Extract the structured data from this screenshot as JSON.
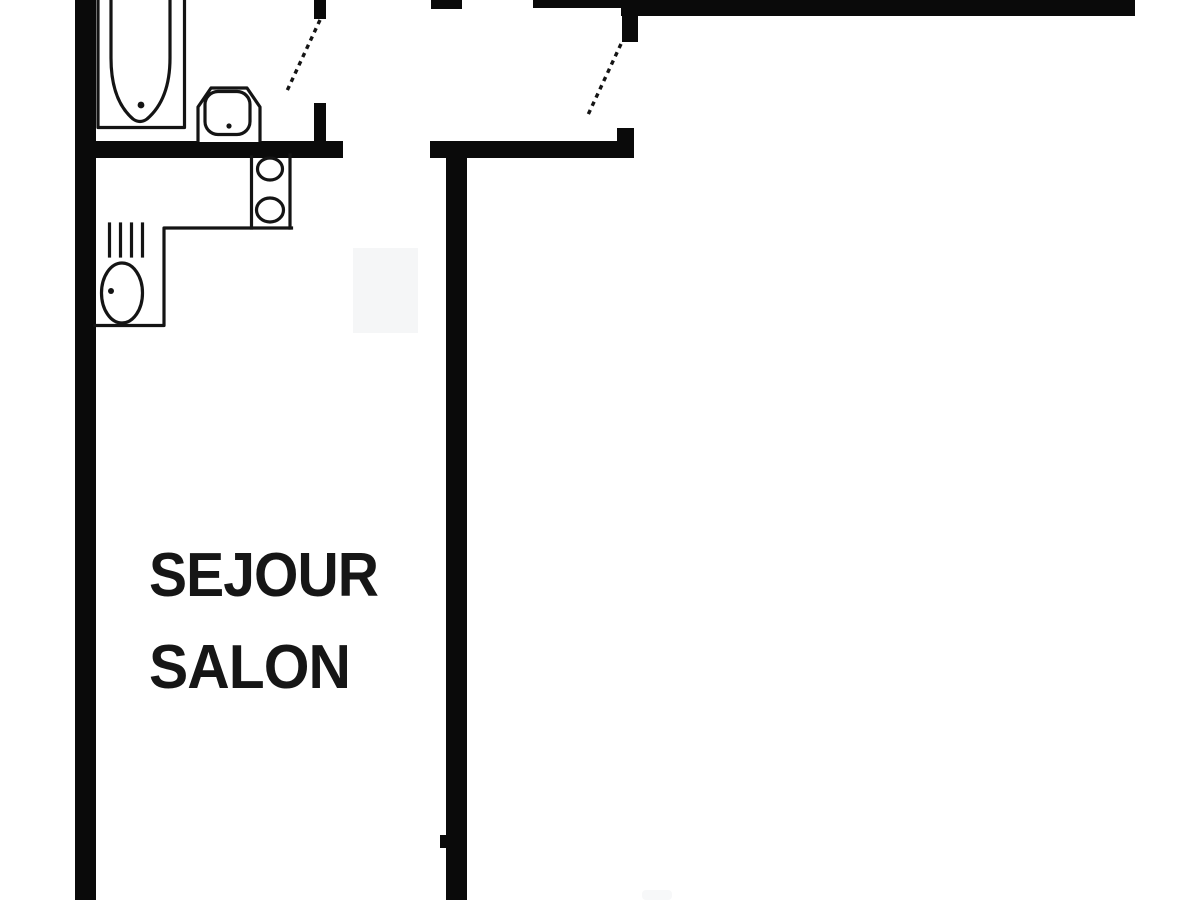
{
  "colors": {
    "background": "#ffffff",
    "walls": "#0a0a0a",
    "fixture_lines": "#141414",
    "label_text": "#161616",
    "faint_patch": "#f5f6f7"
  },
  "rooms": [
    {
      "id": "sejour-salon",
      "lines": [
        "SEJOUR",
        "SALON"
      ]
    }
  ],
  "fixtures": [
    {
      "icon": "bathtub-icon",
      "room": "bathroom"
    },
    {
      "icon": "washbasin-icon",
      "room": "bathroom"
    },
    {
      "icon": "door-swing-icon",
      "room": "bathroom"
    },
    {
      "icon": "stove-burners-icon",
      "room": "kitchen"
    },
    {
      "icon": "kitchen-sink-icon",
      "room": "kitchen"
    },
    {
      "icon": "vent-hatch-icon",
      "room": "kitchen"
    },
    {
      "icon": "door-swing-icon",
      "room": "entry"
    }
  ]
}
